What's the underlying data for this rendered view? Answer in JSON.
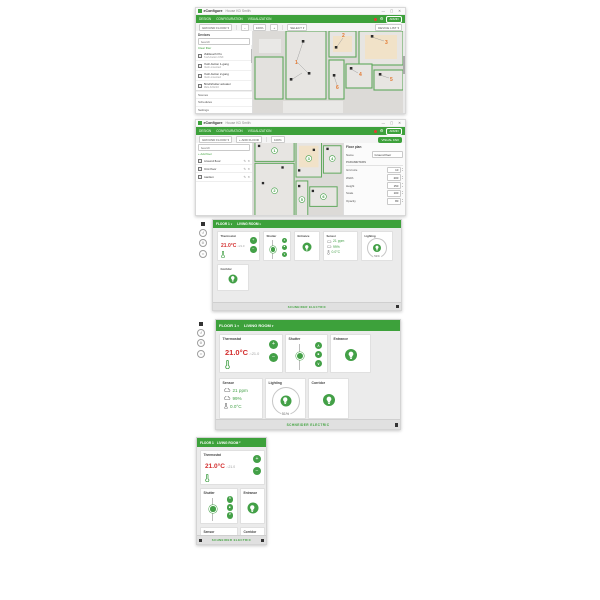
{
  "icons": {
    "minimize": "—",
    "maximize": "▢",
    "close": "✕",
    "caret": "▾",
    "gear": "⚙",
    "undo": "↺",
    "link": "∞",
    "plus": "+",
    "minus": "−",
    "up": "∧",
    "stop": "■",
    "down": "∨",
    "home": "⌂",
    "edit": "✎",
    "remove": "✕",
    "zoom_minus": "−",
    "zoom_plus": "+"
  },
  "window": {
    "app_name": "eConfigure",
    "doc_name": "House KD Smith",
    "menu": [
      "DESIGN",
      "CONFIGURATION",
      "VISUALIZATION"
    ],
    "account_label": "ADMIN"
  },
  "editor1": {
    "toolbar": {
      "floor": "GROUND FLOOR",
      "zoom": "100%",
      "mode": "SELECT",
      "right_label": "DEVICE LIST"
    },
    "sidebar": {
      "title": "Devices",
      "search_placeholder": "Search",
      "filter_link": "Clear filter",
      "devices": [
        {
          "name": "Multitouch Pro",
          "sub": "Push-button KNX"
        },
        {
          "name": "Push-button 1-gang",
          "sub": "Flush-mounted"
        },
        {
          "name": "Push-button 2-gang",
          "sub": "Flush-mounted"
        },
        {
          "name": "Blind/shutter actuator",
          "sub": "REG-K/4x/10"
        },
        {
          "name": "Switch actuator",
          "sub": "REG-K/8x230/10"
        },
        {
          "name": "Universal dimming act.",
          "sub": "REG-K/4x230/150 W"
        },
        {
          "name": "Room thermostat",
          "sub": "Temperature control"
        },
        {
          "name": "Presence detector",
          "sub": "Argus 360"
        },
        {
          "name": "Movement detector",
          "sub": "Argus 180"
        },
        {
          "name": "CO2 / humidity sensor",
          "sub": "KNX ambient"
        },
        {
          "name": "Weather station",
          "sub": "Basic V2"
        },
        {
          "name": "USB interface",
          "sub": "REG-K"
        }
      ],
      "footer": [
        "Scenes",
        "Schedules",
        "Settings"
      ]
    },
    "markers": [
      "1",
      "2",
      "3",
      "4",
      "5",
      "6"
    ]
  },
  "editor2": {
    "toolbar": {
      "floor": "GROUND FLOOR",
      "add_label": "+ ADD FLOOR",
      "zoom": "100%",
      "visual_button": "VISUAL KNX"
    },
    "sidebar": {
      "search_placeholder": "Search",
      "add_link": "+ Add floor",
      "floors": [
        {
          "name": "Ground floor"
        },
        {
          "name": "First floor"
        },
        {
          "name": "Garden"
        }
      ]
    },
    "properties": {
      "title": "Floor plan",
      "name_label": "Name",
      "name_value": "Ground floor",
      "section": "Parameters",
      "rows": [
        {
          "label": "Grid size",
          "value": "10"
        },
        {
          "label": "Width",
          "value": "200"
        },
        {
          "label": "Height",
          "value": "150"
        },
        {
          "label": "Scale",
          "value": "100"
        },
        {
          "label": "Opacity",
          "value": "80"
        }
      ]
    },
    "badges": [
      "1",
      "2",
      "3",
      "4",
      "5",
      "6"
    ]
  },
  "dashboard": {
    "tabs": [
      "FLOOR 1",
      "LIVING ROOM"
    ],
    "footer_brand": "SCHNEIDER ELECTRIC",
    "widgets": {
      "thermostat": {
        "label": "Thermostat",
        "temp": "21.0°C",
        "setpoint": "21.0"
      },
      "shutter": {
        "label": "Shutter"
      },
      "entrance": {
        "label": "Entrance"
      },
      "sensor": {
        "label": "Sensor",
        "co2": "21 ppm",
        "humidity": "99%",
        "temperature": "0.0°C"
      },
      "lighting": {
        "label": "Lighting",
        "value": "51%"
      },
      "corridor": {
        "label": "Corridor"
      }
    }
  },
  "colors": {
    "brand_green": "#3da13b",
    "button_green": "#43a047",
    "temp_red": "#d32f2f",
    "marker_orange": "#e2772e"
  }
}
